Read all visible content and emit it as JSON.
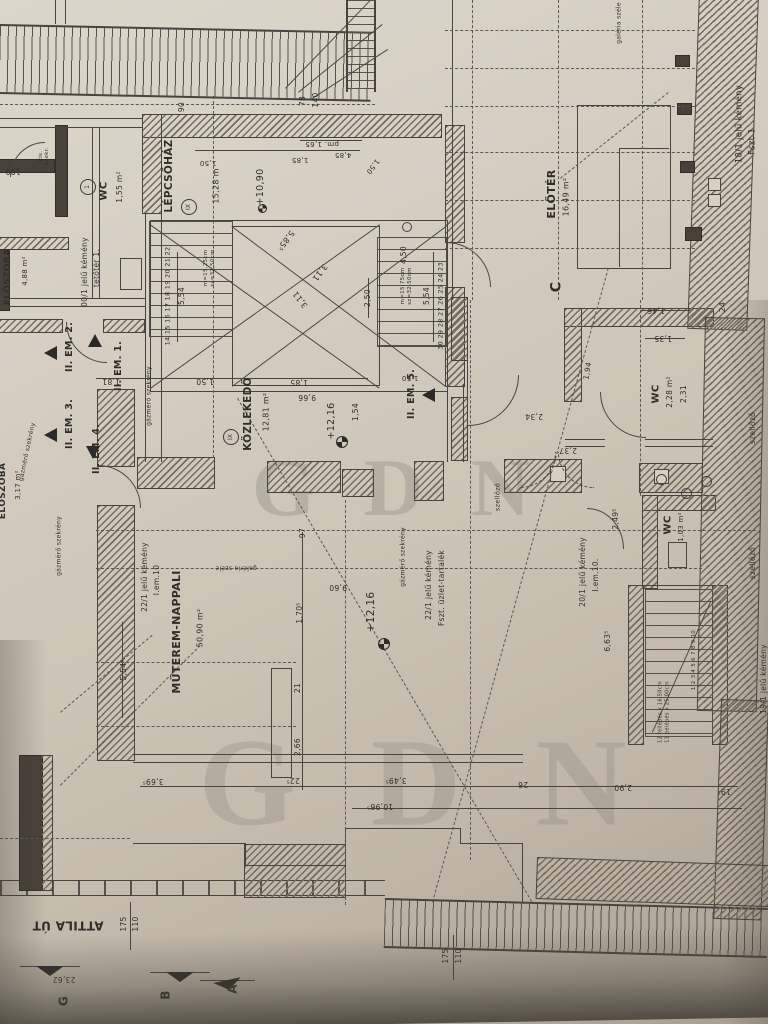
{
  "document_type": "architectural floor plan (scanned photo)",
  "watermark": "GDN",
  "colors": {
    "paper": "#d5cec1",
    "ink": "#45443f",
    "wall_hatch": "#746c5e",
    "shadow": "#6f6a5f"
  },
  "labels": [
    {
      "k": "room-lepcsohaz",
      "t": "LÉPCSŐHÁZ",
      "x": 170,
      "y": 176,
      "r": -90,
      "s": 10.5,
      "b": 1
    },
    {
      "k": "circle-ix-1",
      "t": "IX",
      "x": 189,
      "y": 207,
      "r": -90,
      "s": 6,
      "c": 1
    },
    {
      "k": "stair-length",
      "t": "15,28 m",
      "x": 217,
      "y": 186,
      "r": -90,
      "s": 8
    },
    {
      "k": "level-1090",
      "t": "+10,90",
      "x": 261,
      "y": 187,
      "r": -90,
      "s": 9.5
    },
    {
      "k": "room-wc-top",
      "t": "WC",
      "x": 104,
      "y": 191,
      "r": -90,
      "s": 10,
      "b": 1
    },
    {
      "k": "area-wc-top",
      "t": "1,55 m²",
      "x": 120,
      "y": 187,
      "r": -90,
      "s": 7.5
    },
    {
      "k": "circle-1",
      "t": "1",
      "x": 88,
      "y": 187,
      "r": -90,
      "s": 6,
      "c": 1
    },
    {
      "k": "kemeny00-line1",
      "t": "00/1 jelű kémény",
      "x": 85,
      "y": 272,
      "r": -90,
      "s": 7.5
    },
    {
      "k": "kemeny00-line2",
      "t": "tetőtér 1.",
      "x": 97,
      "y": 268,
      "r": -90,
      "s": 7.5
    },
    {
      "k": "kis-szekreny",
      "t": "kis.\nszekr.",
      "x": 44,
      "y": 156,
      "r": -90,
      "s": 5.5
    },
    {
      "k": "dim-190",
      "t": "190",
      "x": 13,
      "y": 171,
      "r": 180,
      "s": 7.5
    },
    {
      "k": "room-eloszoba-1",
      "t": "ELŐSZOBA",
      "x": 9,
      "y": 277,
      "r": -90,
      "s": 9,
      "b": 1
    },
    {
      "k": "area-eloszoba-1",
      "t": "4,88 m²",
      "x": 26,
      "y": 271,
      "r": -90,
      "s": 7
    },
    {
      "k": "flat-em2",
      "t": "II. EM. 2.",
      "x": 70,
      "y": 347,
      "r": -90,
      "s": 9.5,
      "b": 1
    },
    {
      "k": "flat-em1",
      "t": "II. EM. 1.",
      "x": 119,
      "y": 366,
      "r": -90,
      "s": 9.5,
      "b": 1
    },
    {
      "k": "flat-em3",
      "t": "II. EM. 3.",
      "x": 70,
      "y": 424,
      "r": -90,
      "s": 9.5,
      "b": 1
    },
    {
      "k": "flat-em4",
      "t": "II. EM. 4.",
      "x": 97,
      "y": 449,
      "r": -90,
      "s": 9.5,
      "b": 1
    },
    {
      "k": "flat-em5",
      "t": "II. EM. 5.",
      "x": 412,
      "y": 394,
      "r": -90,
      "s": 9.5,
      "b": 1
    },
    {
      "k": "room-eloszoba-2",
      "t": "ELŐSZOBA",
      "x": 4,
      "y": 491,
      "r": -90,
      "s": 9,
      "b": 1
    },
    {
      "k": "area-eloszoba-2",
      "t": "3,17 m²",
      "x": 19,
      "y": 485,
      "r": -90,
      "s": 7
    },
    {
      "k": "gazmero-1",
      "t": "gázmérő szekrény",
      "x": 28,
      "y": 452,
      "r": -78,
      "s": 6
    },
    {
      "k": "gazmero-2",
      "t": "gázmérő szekrény",
      "x": 60,
      "y": 546,
      "r": -90,
      "s": 6
    },
    {
      "k": "gazmero-3",
      "t": "gázmérő szekrény",
      "x": 150,
      "y": 396,
      "r": -90,
      "s": 6
    },
    {
      "k": "gazmero-4",
      "t": "gázmérő szekrény",
      "x": 404,
      "y": 557,
      "r": -90,
      "s": 6
    },
    {
      "k": "szellozo-1",
      "t": "szellőző",
      "x": 498,
      "y": 497,
      "r": -90,
      "s": 6.5
    },
    {
      "k": "szellozo-2",
      "t": "szellőző",
      "x": 753,
      "y": 428,
      "r": -90,
      "s": 7.5
    },
    {
      "k": "szellozo-3",
      "t": "szellőző",
      "x": 753,
      "y": 563,
      "r": -90,
      "s": 7.5
    },
    {
      "k": "room-wc-right",
      "t": "WC",
      "x": 656,
      "y": 394,
      "r": -90,
      "s": 10,
      "b": 1
    },
    {
      "k": "area-wc-right",
      "t": "2,28 m²",
      "x": 670,
      "y": 392,
      "r": -90,
      "s": 7.5
    },
    {
      "k": "dim-231",
      "t": "2,31",
      "x": 684,
      "y": 394,
      "r": -90,
      "s": 7.5
    },
    {
      "k": "room-wc-bottom",
      "t": "WC",
      "x": 668,
      "y": 525,
      "r": -90,
      "s": 10,
      "b": 1
    },
    {
      "k": "area-wc-bottom",
      "t": "1,03 m²",
      "x": 682,
      "y": 527,
      "r": -90,
      "s": 7
    },
    {
      "k": "room-eloter",
      "t": "ELŐTÉR",
      "x": 552,
      "y": 194,
      "r": -90,
      "s": 11,
      "b": 1
    },
    {
      "k": "area-eloter",
      "t": "16,49 m²",
      "x": 567,
      "y": 197,
      "r": -90,
      "s": 8
    },
    {
      "k": "axis-c",
      "t": "C",
      "x": 557,
      "y": 287,
      "r": -90,
      "s": 14,
      "b": 1
    },
    {
      "k": "kemeny18-line1",
      "t": "18/1 jelű kémény",
      "x": 740,
      "y": 124,
      "r": -90,
      "s": 8.5
    },
    {
      "k": "kemeny18-line2",
      "t": "Fszt 1.",
      "x": 753,
      "y": 140,
      "r": -90,
      "s": 8.5
    },
    {
      "k": "galeria-1",
      "t": "galéria széle",
      "x": 620,
      "y": 23,
      "r": -90,
      "s": 6
    },
    {
      "k": "galeria-2",
      "t": "galéria széle",
      "x": 236,
      "y": 567,
      "r": 180,
      "s": 6
    },
    {
      "k": "room-muterem",
      "t": "MŰTEREM-NAPPALI",
      "x": 177,
      "y": 632,
      "r": -90,
      "s": 11,
      "b": 1
    },
    {
      "k": "area-muterem",
      "t": "50,90 m²",
      "x": 201,
      "y": 628,
      "r": -90,
      "s": 8
    },
    {
      "k": "kemeny22a-line1",
      "t": "22/1 jelű kémény",
      "x": 145,
      "y": 577,
      "r": -90,
      "s": 7.5
    },
    {
      "k": "kemeny22a-line2",
      "t": "I.em.10",
      "x": 157,
      "y": 580,
      "r": -90,
      "s": 7.5
    },
    {
      "k": "kemeny22b-line1",
      "t": "22/1 jelű kémény",
      "x": 429,
      "y": 585,
      "r": -90,
      "s": 7.5
    },
    {
      "k": "kemeny22b-line2",
      "t": "Fszt. üzlet-tartalék",
      "x": 442,
      "y": 588,
      "r": -90,
      "s": 7.5
    },
    {
      "k": "kemeny20-line1",
      "t": "20/1 jelű kémény",
      "x": 583,
      "y": 572,
      "r": -90,
      "s": 7.5
    },
    {
      "k": "kemeny20-line2",
      "t": "I.em.10.",
      "x": 596,
      "y": 575,
      "r": -90,
      "s": 7.5
    },
    {
      "k": "kemeny19",
      "t": "19/1 jelű kémény",
      "x": 764,
      "y": 679,
      "r": -90,
      "s": 7.5
    },
    {
      "k": "level-1216-a",
      "t": "+12,16",
      "x": 332,
      "y": 421,
      "r": -90,
      "s": 9.5
    },
    {
      "k": "level-1216-b",
      "t": "+12,16",
      "x": 372,
      "y": 612,
      "r": -90,
      "s": 10.5
    },
    {
      "k": "dim-960",
      "t": "9,60",
      "x": 338,
      "y": 587,
      "r": 180,
      "s": 7.5
    },
    {
      "k": "dim-966",
      "t": "9,66",
      "x": 307,
      "y": 397,
      "r": 180,
      "s": 7.5
    },
    {
      "k": "dim-185a",
      "t": "1,85",
      "x": 299,
      "y": 382,
      "r": 180,
      "s": 7.5
    },
    {
      "k": "dim-150a",
      "t": "1,50",
      "x": 205,
      "y": 381,
      "r": 180,
      "s": 7.5
    },
    {
      "k": "dim-181",
      "t": "1,81",
      "x": 111,
      "y": 381,
      "r": 180,
      "s": 7.5
    },
    {
      "k": "dim-154",
      "t": "1,54",
      "x": 356,
      "y": 412,
      "r": -90,
      "s": 7.5
    },
    {
      "k": "dim-585",
      "t": "5,85⁵",
      "x": 285,
      "y": 240,
      "r": 127,
      "s": 8
    },
    {
      "k": "dim-311a",
      "t": "3,11",
      "x": 319,
      "y": 272,
      "r": 127,
      "s": 8
    },
    {
      "k": "dim-311b",
      "t": "3,11",
      "x": 301,
      "y": 299,
      "r": -127,
      "s": 8
    },
    {
      "k": "dim-250",
      "t": "2,50",
      "x": 368,
      "y": 298,
      "r": -90,
      "s": 7.5
    },
    {
      "k": "dim-450",
      "t": "4,50",
      "x": 404,
      "y": 255,
      "r": -90,
      "s": 7.5
    },
    {
      "k": "dim-554a",
      "t": "5,54",
      "x": 182,
      "y": 296,
      "r": -90,
      "s": 7.5
    },
    {
      "k": "dim-554b",
      "t": "5,54",
      "x": 427,
      "y": 296,
      "r": -90,
      "s": 7.5
    },
    {
      "k": "stair-pitch-a1",
      "t": "m=15,25cm",
      "x": 206,
      "y": 268,
      "r": -90,
      "s": 5.5
    },
    {
      "k": "stair-pitch-a2",
      "t": "sz=32,50cm",
      "x": 213,
      "y": 268,
      "r": -90,
      "s": 5.5
    },
    {
      "k": "stair-pitch-b1",
      "t": "m=15,75cm",
      "x": 403,
      "y": 286,
      "r": -90,
      "s": 5.5
    },
    {
      "k": "stair-pitch-b2",
      "t": "sz=32,50cm",
      "x": 410,
      "y": 286,
      "r": -90,
      "s": 5.5
    },
    {
      "k": "stair-numbers-left",
      "t": "14 15 16 17 18 19 20 21 22",
      "x": 168,
      "y": 296,
      "r": -90,
      "s": 6.5
    },
    {
      "k": "stair-numbers-right",
      "t": "30 29 28 27 26 25 24 23",
      "x": 441,
      "y": 306,
      "r": -90,
      "s": 6.5
    },
    {
      "k": "room-kozlekedo",
      "t": "KÖZLEKEDŐ",
      "x": 249,
      "y": 414,
      "r": -90,
      "s": 10.5,
      "b": 1
    },
    {
      "k": "area-kozlekedo",
      "t": "12,81 m²",
      "x": 267,
      "y": 412,
      "r": -90,
      "s": 8
    },
    {
      "k": "circle-ix-2",
      "t": "IX",
      "x": 231,
      "y": 437,
      "r": -90,
      "s": 6,
      "c": 1
    },
    {
      "k": "dim-90",
      "t": "90",
      "x": 182,
      "y": 107,
      "r": -90,
      "s": 7.5
    },
    {
      "k": "dim-78",
      "t": "78",
      "x": 303,
      "y": 101,
      "r": -90,
      "s": 7.5
    },
    {
      "k": "dim-140",
      "t": "140",
      "x": 316,
      "y": 100,
      "r": -90,
      "s": 7.5
    },
    {
      "k": "dim-pm165",
      "t": "pm. 1,65",
      "x": 322,
      "y": 143,
      "r": 180,
      "s": 7
    },
    {
      "k": "dim-185b",
      "t": "1,85",
      "x": 300,
      "y": 159,
      "r": 180,
      "s": 7
    },
    {
      "k": "dim-485",
      "t": "4,85",
      "x": 343,
      "y": 154,
      "r": 180,
      "s": 7
    },
    {
      "k": "dim-150b",
      "t": "1,50",
      "x": 208,
      "y": 162,
      "r": 180,
      "s": 7
    },
    {
      "k": "dim-150c",
      "t": "1,50",
      "x": 372,
      "y": 166,
      "r": 127,
      "s": 7
    },
    {
      "k": "dim-150d",
      "t": "1,50",
      "x": 410,
      "y": 377,
      "r": 180,
      "s": 7
    },
    {
      "k": "dim-1705",
      "t": "1,70⁵",
      "x": 300,
      "y": 613,
      "r": -90,
      "s": 7.5
    },
    {
      "k": "dim-21",
      "t": "21",
      "x": 298,
      "y": 688,
      "r": -90,
      "s": 7.5
    },
    {
      "k": "dim-266",
      "t": "2,66",
      "x": 298,
      "y": 747,
      "r": -90,
      "s": 7.5
    },
    {
      "k": "dim-97",
      "t": "97",
      "x": 303,
      "y": 533,
      "r": -90,
      "s": 7.5
    },
    {
      "k": "dim-5545",
      "t": "5,54⁵",
      "x": 124,
      "y": 670,
      "r": -90,
      "s": 7.5
    },
    {
      "k": "dim-3695",
      "t": "3,69⁵",
      "x": 153,
      "y": 781,
      "r": 180,
      "s": 7.5
    },
    {
      "k": "dim-225",
      "t": "22⁵",
      "x": 293,
      "y": 780,
      "r": 180,
      "s": 7.5
    },
    {
      "k": "dim-3495",
      "t": "3,49⁵",
      "x": 396,
      "y": 780,
      "r": 180,
      "s": 7.5
    },
    {
      "k": "dim-26",
      "t": "26",
      "x": 523,
      "y": 784,
      "r": 180,
      "s": 7.5
    },
    {
      "k": "dim-290",
      "t": "2,90",
      "x": 623,
      "y": 787,
      "r": 180,
      "s": 7.5
    },
    {
      "k": "dim-195",
      "t": "19⁵",
      "x": 724,
      "y": 791,
      "r": 180,
      "s": 7.5
    },
    {
      "k": "dim-10965",
      "t": "10,96⁵",
      "x": 380,
      "y": 806,
      "r": 180,
      "s": 7.5
    },
    {
      "k": "dim-175a",
      "t": "175",
      "x": 124,
      "y": 924,
      "r": -90,
      "s": 7.5
    },
    {
      "k": "dim-110a",
      "t": "110",
      "x": 136,
      "y": 924,
      "r": -90,
      "s": 7.5
    },
    {
      "k": "dim-175b",
      "t": "175",
      "x": 446,
      "y": 956,
      "r": -90,
      "s": 7.5
    },
    {
      "k": "dim-110b",
      "t": "110",
      "x": 459,
      "y": 956,
      "r": -90,
      "s": 7.5
    },
    {
      "k": "street-name",
      "t": "ATTILA ÚT",
      "x": 68,
      "y": 925,
      "r": 180,
      "s": 12,
      "b": 1
    },
    {
      "k": "dim-2362",
      "t": "23,62",
      "x": 64,
      "y": 979,
      "r": 180,
      "s": 7.5
    },
    {
      "k": "axis-g",
      "t": "G",
      "x": 64,
      "y": 1001,
      "r": -90,
      "s": 12,
      "b": 1
    },
    {
      "k": "axis-b",
      "t": "B",
      "x": 166,
      "y": 995,
      "r": -90,
      "s": 12,
      "b": 1
    },
    {
      "k": "axis-a",
      "t": "A",
      "x": 233,
      "y": 989,
      "r": -90,
      "s": 12,
      "b": 1
    },
    {
      "k": "dim-146",
      "t": "1,46",
      "x": 656,
      "y": 310,
      "r": 180,
      "s": 7.5
    },
    {
      "k": "dim-135",
      "t": "1,35",
      "x": 663,
      "y": 338,
      "r": 180,
      "s": 7.5
    },
    {
      "k": "dim-24",
      "t": "24",
      "x": 723,
      "y": 307,
      "r": -90,
      "s": 7.5
    },
    {
      "k": "dim-194",
      "t": "1,94",
      "x": 588,
      "y": 371,
      "r": -80,
      "s": 7.5
    },
    {
      "k": "dim-234",
      "t": "2,34",
      "x": 534,
      "y": 416,
      "r": 180,
      "s": 7.5
    },
    {
      "k": "dim-237",
      "t": "2,37",
      "x": 568,
      "y": 450,
      "r": 180,
      "s": 7.5
    },
    {
      "k": "dim-2495",
      "t": "2,49⁵",
      "x": 616,
      "y": 519,
      "r": -90,
      "s": 7.5
    },
    {
      "k": "dim-6635",
      "t": "6,63⁵",
      "x": 608,
      "y": 641,
      "r": -90,
      "s": 7.5
    },
    {
      "k": "stair2-pitch-1",
      "t": "12 fellépés x 16,50cm",
      "x": 661,
      "y": 712,
      "r": -90,
      "s": 5
    },
    {
      "k": "stair2-pitch-2",
      "t": "11 belépés x 25,00cm",
      "x": 668,
      "y": 712,
      "r": -90,
      "s": 5
    },
    {
      "k": "stair2-numbers",
      "t": "1 2 3 4 5 6 7 8 9 10",
      "x": 694,
      "y": 660,
      "r": -90,
      "s": 5.5
    }
  ]
}
